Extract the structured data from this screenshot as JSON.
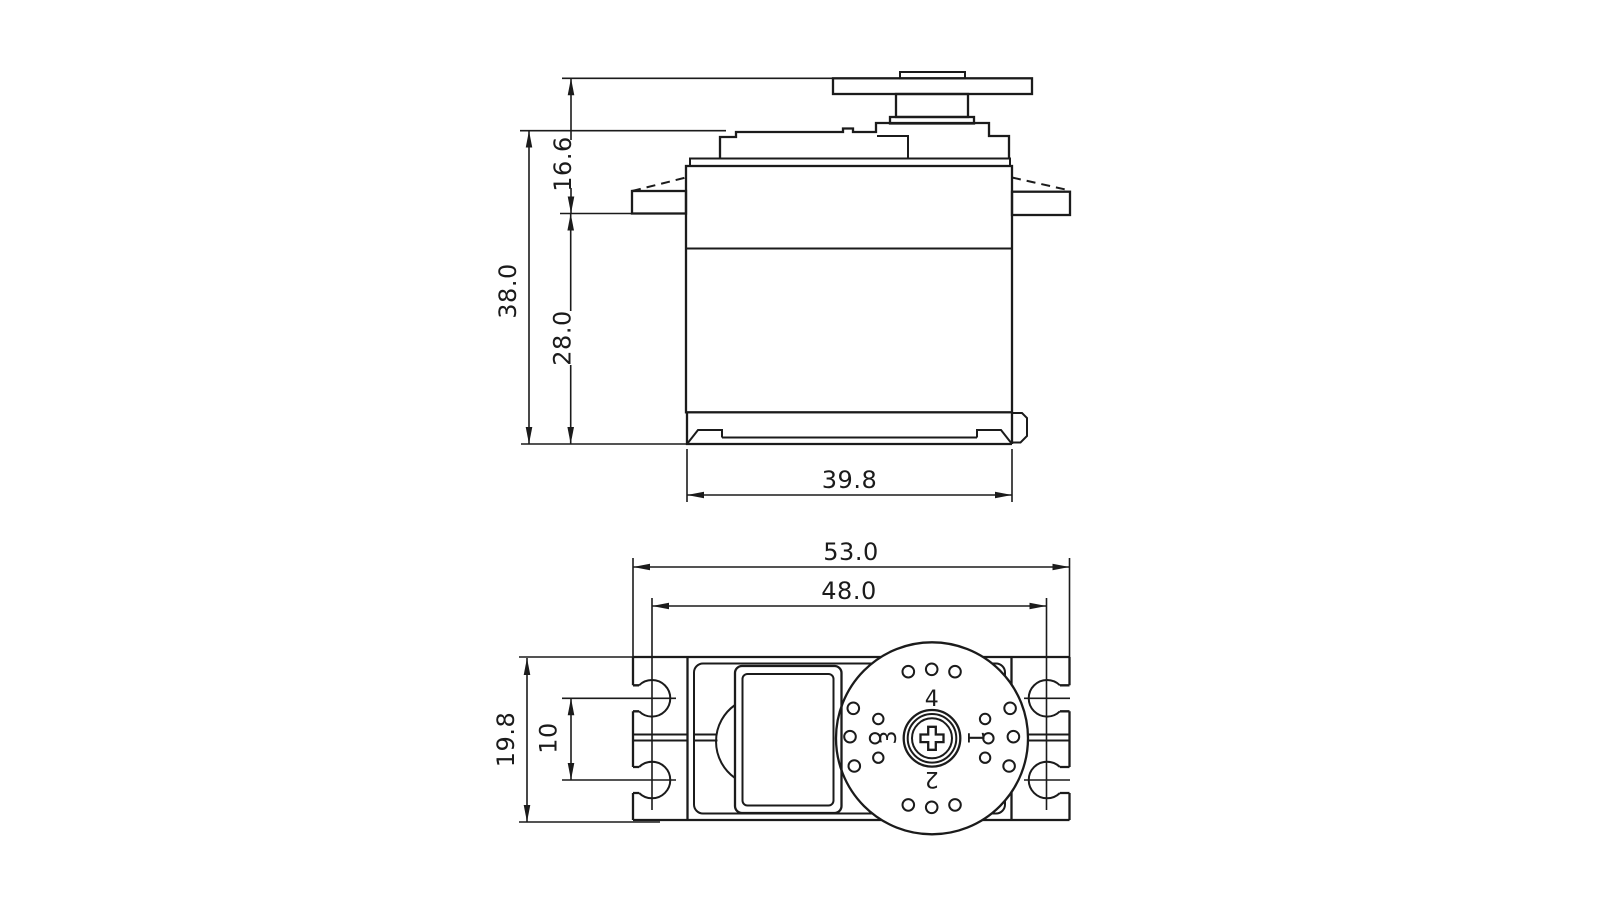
{
  "drawing_type": "servo-dimensional-drawing",
  "colors": {
    "line": "#1b1b1b",
    "background": "#ffffff"
  },
  "front_view": {
    "dim_overall_height": "38.0",
    "dim_horn_to_mount": "16.6",
    "dim_mount_to_bottom": "28.0",
    "dim_body_width": "39.8"
  },
  "plan_view": {
    "dim_overall_width": "53.0",
    "dim_mount_hole_span": "48.0",
    "dim_body_depth": "19.8",
    "dim_mount_hole_pitch": "10",
    "horn_arms": {
      "right": "1",
      "bottom": "2",
      "left": "3",
      "top": "4"
    }
  }
}
